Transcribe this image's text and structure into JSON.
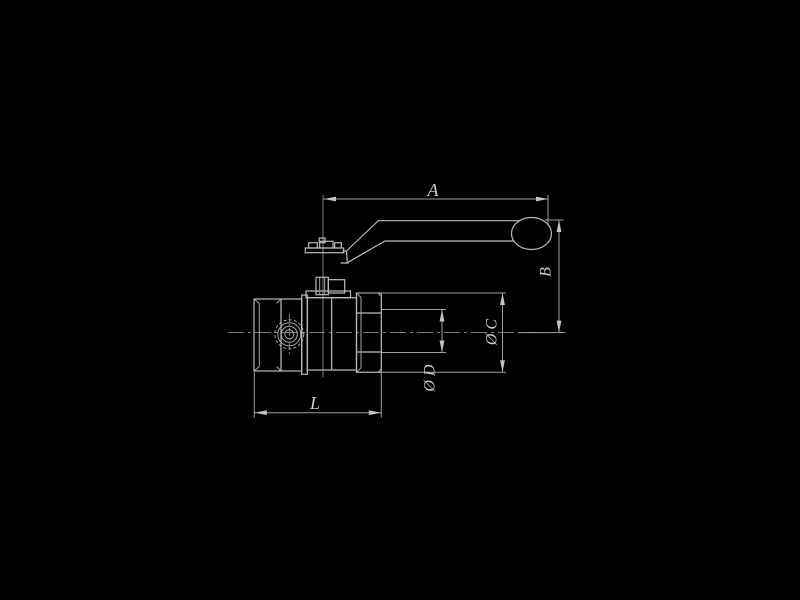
{
  "page": {
    "background": "#000000",
    "description": "Black-background engineering line drawing of a ball valve with lever handle, side view, with dimension callouts"
  },
  "drawing": {
    "colors": {
      "background": "#000000",
      "object_line": "#bcbcbc",
      "dimension_line": "#9e9e9e",
      "centerline": "#8a8a8a",
      "label_text": "#cccccc"
    },
    "labels": {
      "a": "A",
      "b": "B",
      "c": "Ø C",
      "d": "Ø D",
      "l": "L"
    }
  }
}
